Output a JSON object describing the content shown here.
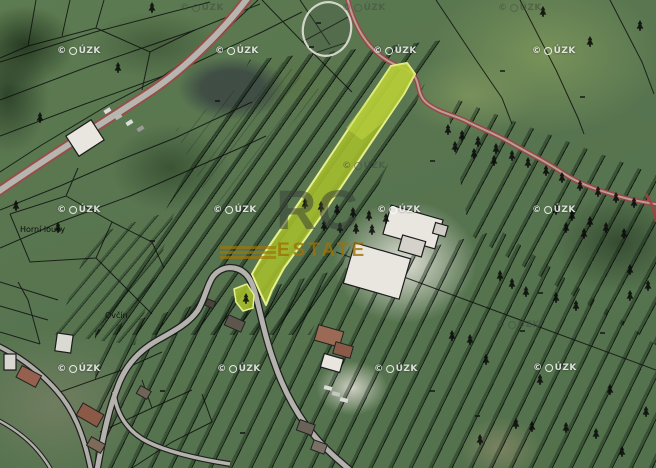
{
  "watermarks": {
    "copyright": {
      "full_label": "© ČÚZK",
      "symbol": "©",
      "logo_icon": "cuzk-circle-logo",
      "text": "ÚZK"
    },
    "brand": {
      "line1": "RC",
      "line2": "ESTATE"
    }
  },
  "labels": {
    "field_left": "Horní louky",
    "field_center": "Ovčín"
  },
  "map_features": {
    "highlighted_parcel": "long diagonal strip parcel highlighted yellow-green with small detached piece at road hairpin",
    "roads": [
      "red-edged road upper left",
      "red winding road upper right",
      "gray serpentine road lower center",
      "village road lower left"
    ],
    "terrain": "aerial photo with strip field parcels and cadastral boundary overlay"
  },
  "colors": {
    "highlight_fill": "#a9c22b",
    "highlight_border": "#e7f08d",
    "road_asphalt": "#b5b3ad",
    "road_boundary_red": "#a04343",
    "parcel_line": "#0d0d0d",
    "brand_rc": "rgba(56,63,56,0.52)",
    "brand_estate": "rgba(158,114,6,0.8)",
    "cuzk_watermark": "rgba(255,255,255,0.82)"
  }
}
